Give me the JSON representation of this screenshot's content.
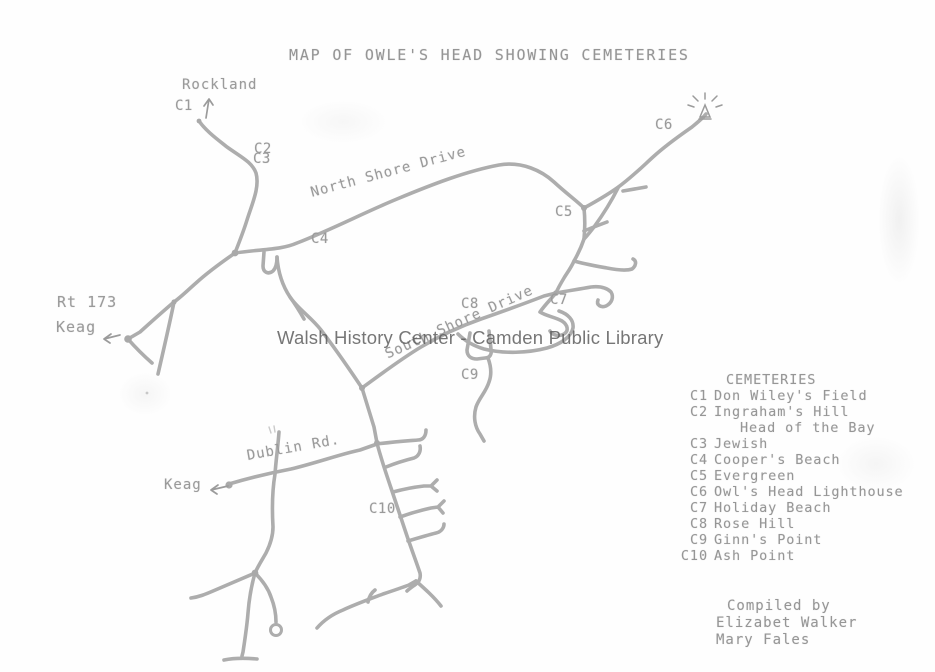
{
  "title": "MAP OF OWLE'S HEAD SHOWING CEMETERIES",
  "watermark": "Walsh History Center - Camden Public Library",
  "map_labels": {
    "rockland": "Rockland",
    "rt173": "Rt 173",
    "keag_west": "Keag",
    "keag_south": "Keag",
    "north_shore_drive": "North Shore Drive",
    "south_shore_drive": "South Shore Drive",
    "dublin_rd": "Dublin Rd."
  },
  "markers": {
    "c1": "C1",
    "c2": "C2",
    "c3": "C3",
    "c4": "C4",
    "c5": "C5",
    "c6": "C6",
    "c7": "C7",
    "c8": "C8",
    "c9": "C9",
    "c10": "C10"
  },
  "legend": {
    "heading": "CEMETERIES",
    "items": [
      {
        "code": "C1",
        "name": "Don Wiley's Field"
      },
      {
        "code": "C2",
        "name": "Ingraham's Hill"
      },
      {
        "code": "",
        "name": "Head of the Bay"
      },
      {
        "code": "C3",
        "name": "Jewish"
      },
      {
        "code": "C4",
        "name": "Cooper's Beach"
      },
      {
        "code": "C5",
        "name": "Evergreen"
      },
      {
        "code": "C6",
        "name": "Owl's Head Lighthouse"
      },
      {
        "code": "C7",
        "name": "Holiday Beach"
      },
      {
        "code": "C8",
        "name": "Rose Hill"
      },
      {
        "code": "C9",
        "name": "Ginn's Point"
      },
      {
        "code": "C10",
        "name": "Ash Point"
      }
    ]
  },
  "credits": {
    "line1": "Compiled by",
    "line2": "Elizabet Walker",
    "line3": "Mary Fales"
  },
  "icons": {
    "lighthouse": "lighthouse-icon",
    "arrow_up": "arrow-up-icon",
    "arrow_left": "arrow-left-icon"
  },
  "colors": {
    "road": "#a9a9a9",
    "ink": "#9a9a9a",
    "watermark": "#5f5f5f",
    "paper": "#fefefe"
  }
}
